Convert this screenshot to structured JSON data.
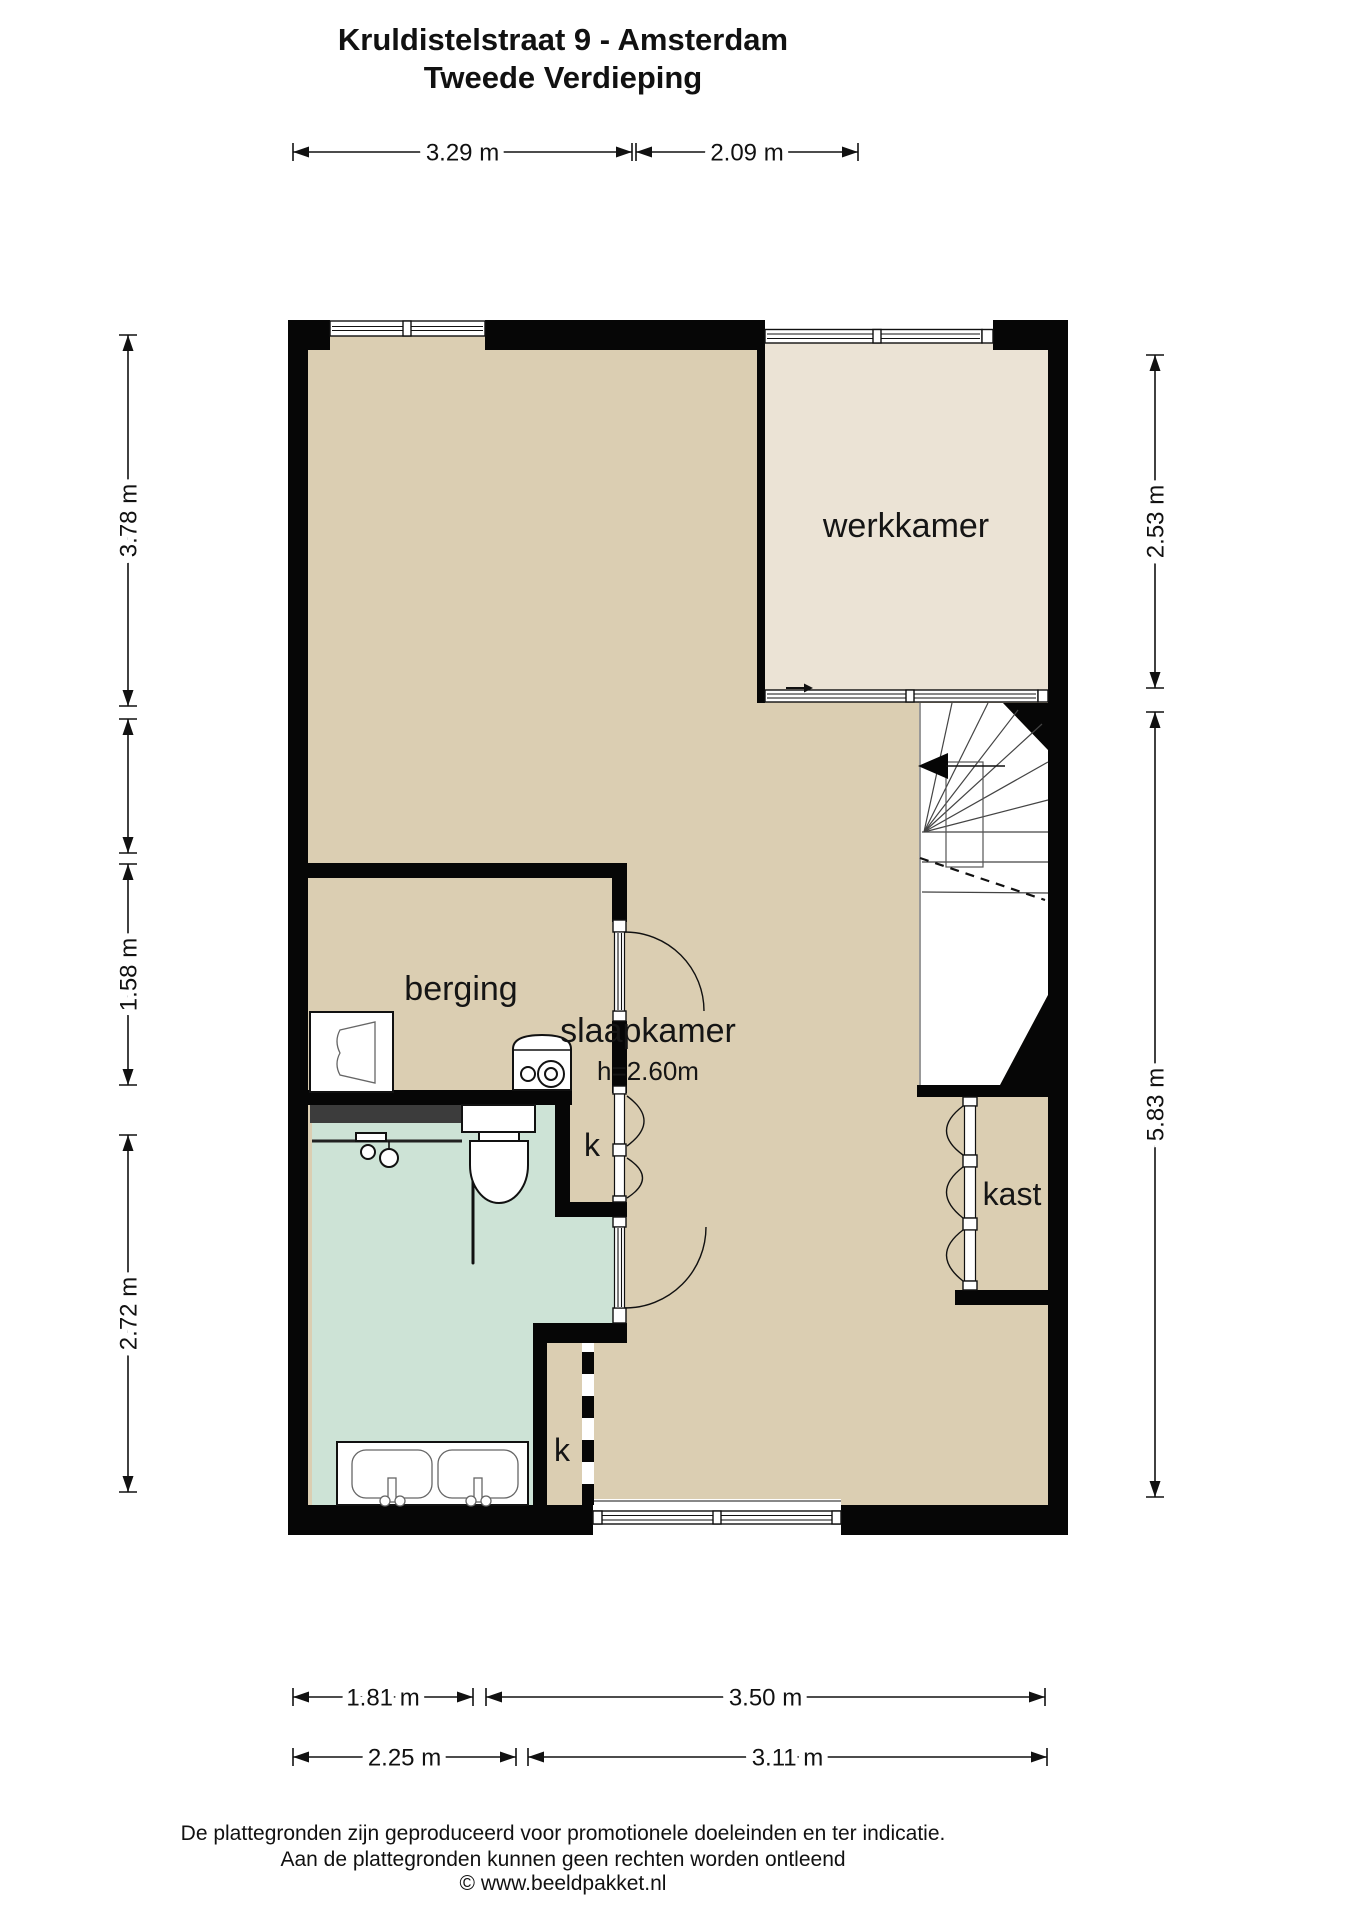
{
  "title": {
    "line1": "Kruldistelstraat 9 - Amsterdam",
    "line2": "Tweede Verdieping"
  },
  "rooms": [
    {
      "id": "werkkamer",
      "label": "werkkamer",
      "x": 906,
      "y": 537,
      "size": 34
    },
    {
      "id": "slaapkamer",
      "label": "slaapkamer",
      "x": 648,
      "y": 1042,
      "size": 34
    },
    {
      "id": "slaapkamer-height",
      "label": "h=2.60m",
      "x": 648,
      "y": 1080,
      "size": 26
    },
    {
      "id": "berging",
      "label": "berging",
      "x": 461,
      "y": 1000,
      "size": 34
    },
    {
      "id": "kast",
      "label": "kast",
      "x": 1012,
      "y": 1205,
      "size": 32
    },
    {
      "id": "closet-k1",
      "label": "k",
      "x": 592,
      "y": 1156,
      "size": 32
    },
    {
      "id": "closet-k2",
      "label": "k",
      "x": 562,
      "y": 1461,
      "size": 32
    }
  ],
  "dimensions": {
    "top": [
      {
        "label": "3.29 m",
        "from": 293,
        "to": 632,
        "pos": 152
      },
      {
        "label": "2.09 m",
        "from": 636,
        "to": 858,
        "pos": 152
      }
    ],
    "left": [
      {
        "label": "3.78 m",
        "from": 335,
        "to": 706,
        "pos": 128
      },
      {
        "label": "",
        "from": 719,
        "to": 853,
        "pos": 128
      },
      {
        "label": "1.58 m",
        "from": 864,
        "to": 1085,
        "pos": 128
      },
      {
        "label": "2.72 m",
        "from": 1135,
        "to": 1492,
        "pos": 128
      }
    ],
    "right": [
      {
        "label": "2.53 m",
        "from": 355,
        "to": 688,
        "pos": 1155
      },
      {
        "label": "5.83 m",
        "from": 712,
        "to": 1497,
        "pos": 1155
      }
    ],
    "bottom_row1": [
      {
        "label": "1.81 m",
        "from": 293,
        "to": 473,
        "pos": 1697
      },
      {
        "label": "3.50 m",
        "from": 486,
        "to": 1045,
        "pos": 1697
      }
    ],
    "bottom_row2": [
      {
        "label": "2.25 m",
        "from": 293,
        "to": 516,
        "pos": 1757
      },
      {
        "label": "3.11 m",
        "from": 528,
        "to": 1047,
        "pos": 1757
      }
    ]
  },
  "footer": {
    "line1": "De plattegronden zijn geproduceerd voor promotionele doeleinden en ter indicatie.",
    "line2": "Aan de plattegronden kunnen geen rechten worden ontleend",
    "line3": "© www.beeldpakket.nl"
  },
  "colors": {
    "wall": "#060606",
    "floor_main": "#dbceb2",
    "floor_werkkamer": "#ebe3d5",
    "floor_bathroom": "#cde3d6",
    "shower_wall": "#3c3c3c"
  }
}
